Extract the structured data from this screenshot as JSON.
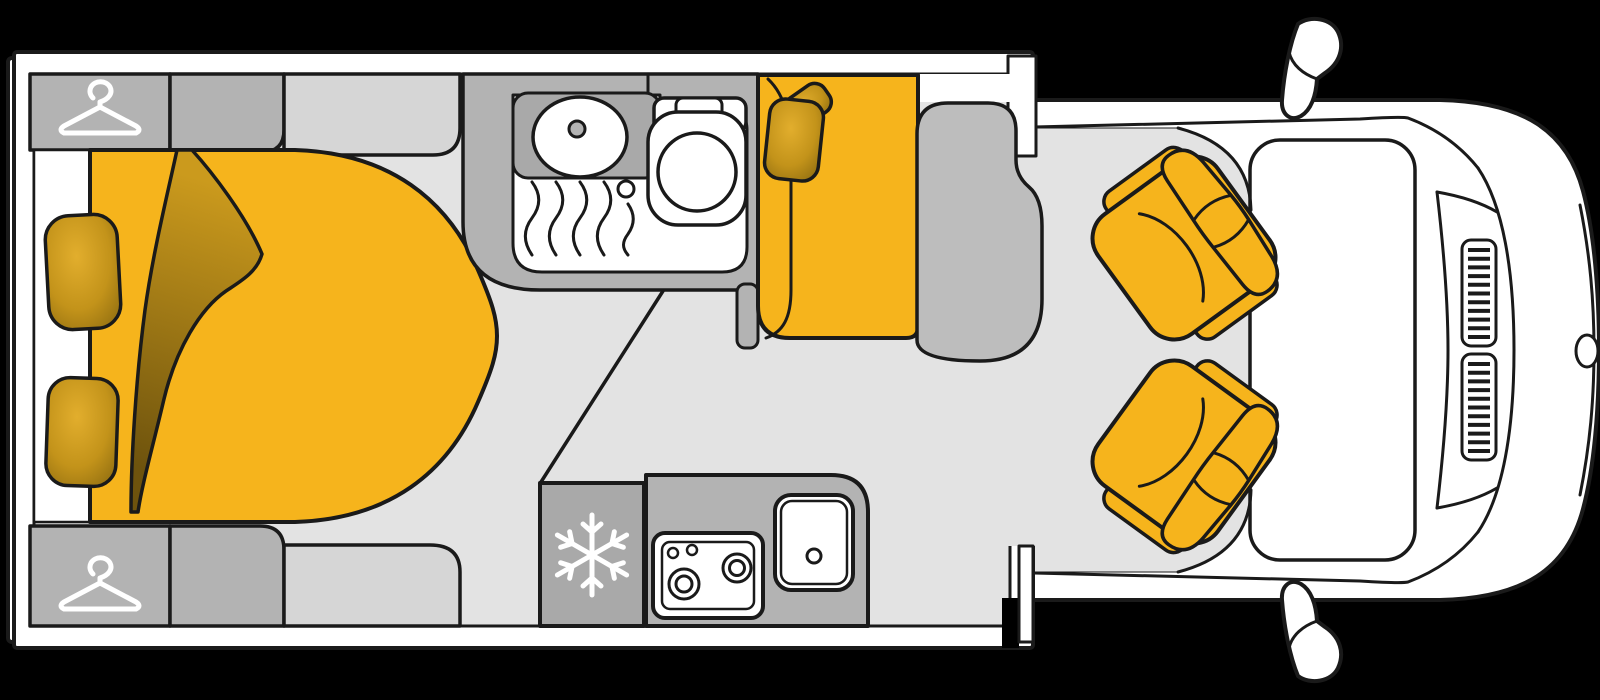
{
  "app": {
    "title": "Motorhome floor plan"
  },
  "diagram": {
    "type": "floorplan-top-view",
    "subject": "motorhome interior layout with driver cab",
    "orientation": "vehicle front on the right, rear on the left",
    "colors": {
      "background": "#000000",
      "outline": "#1a1a1a",
      "wall_white": "#ffffff",
      "floor": "#e3e3e3",
      "cabinet_gray": "#b3b3b3",
      "cabinet_gray_light": "#d6d6d6",
      "appliance_gray": "#a9a9a9",
      "table_gray": "#bdbdbd",
      "accent_yellow": "#f6b41c",
      "gold_light": "#e2ae2d",
      "gold_mid": "#c3931a",
      "gold_dark": "#8a690f",
      "duvet_light": "#cb9a1d",
      "duvet_dark": "#6e530d",
      "icon_white": "#ffffff"
    },
    "icons": {
      "hanger": "clothes-hanger-icon",
      "snowflake": "snowflake-icon"
    },
    "rooms": [
      {
        "id": "bedroom",
        "label": "Rear bedroom",
        "fixtures": [
          "double bed",
          "folded duvet corner",
          "2 pillows",
          "2 wardrobes with hanger symbol",
          "2 overhead cabinets"
        ]
      },
      {
        "id": "washroom",
        "label": "Washroom",
        "fixtures": [
          "vanity with oval basin",
          "shower tray with drain",
          "toilet"
        ]
      },
      {
        "id": "kitchen",
        "label": "Kitchen",
        "fixtures": [
          "fridge with snowflake symbol",
          "2-burner hob with knobs",
          "sink",
          "worktop"
        ]
      },
      {
        "id": "lounge",
        "label": "Lounge / dinette",
        "fixtures": [
          "sofa bench with 2 cushions",
          "side table"
        ]
      },
      {
        "id": "cab",
        "label": "Driver cab",
        "fixtures": [
          "2 swivel captain seats",
          "windscreen",
          "2 wing mirrors",
          "bonnet grilles",
          "front badge"
        ]
      }
    ]
  }
}
